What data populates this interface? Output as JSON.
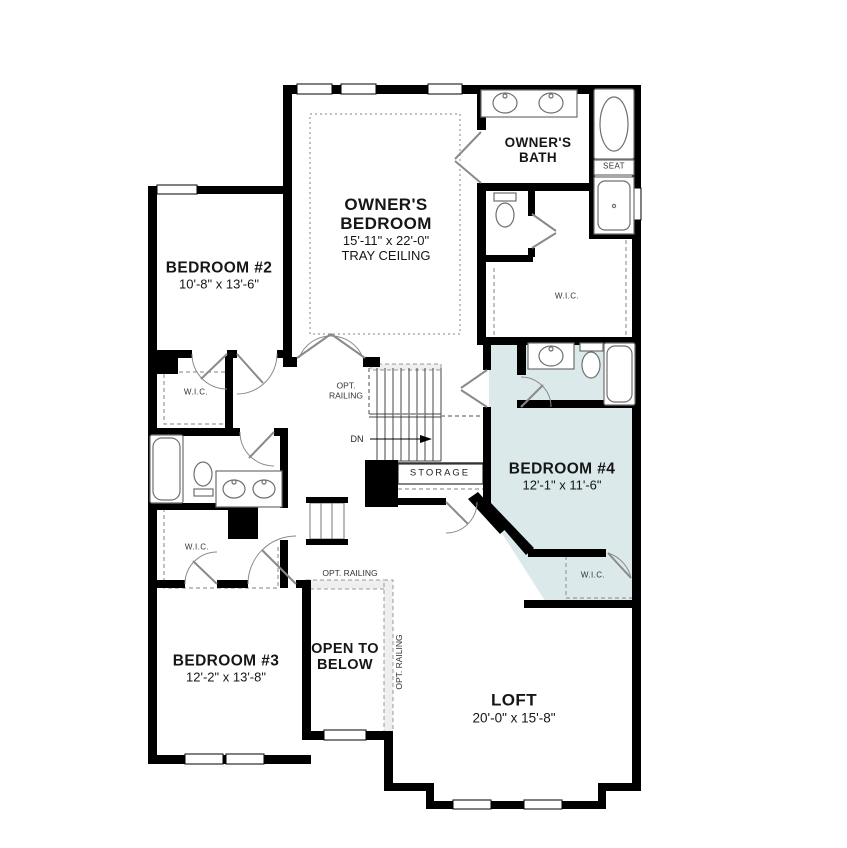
{
  "plan": {
    "colors": {
      "highlight": "#dbe9eb",
      "wall": "#000000"
    },
    "rooms": {
      "owners_bedroom": {
        "name": "OWNER'S BEDROOM",
        "dims": "15'-11\" x 22'-0\"",
        "note": "TRAY CEILING"
      },
      "owners_bath": {
        "name": "OWNER'S BATH"
      },
      "bedroom2": {
        "name": "BEDROOM #2",
        "dims": "10'-8\" x 13'-6\""
      },
      "bedroom3": {
        "name": "BEDROOM #3",
        "dims": "12'-2\" x 13'-8\""
      },
      "bedroom4": {
        "name": "BEDROOM #4",
        "dims": "12'-1\" x 11'-6\""
      },
      "loft": {
        "name": "LOFT",
        "dims": "20'-0\" x 15'-8\""
      },
      "open_to_below": {
        "name": "OPEN TO BELOW"
      }
    },
    "labels": {
      "wic": "W.I.C.",
      "seat": "SEAT",
      "storage": "STORAGE",
      "down": "DN",
      "opt_railing": "OPT. RAILING"
    }
  }
}
